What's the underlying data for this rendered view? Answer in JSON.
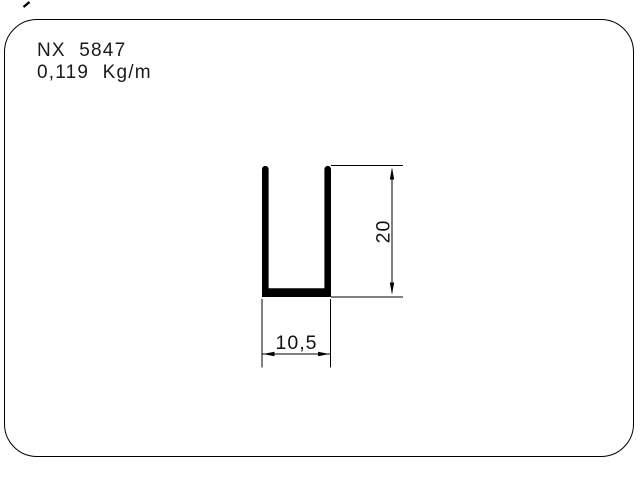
{
  "colors": {
    "background": "#ffffff",
    "line": "#000000",
    "text": "#1a1a1a"
  },
  "header": {
    "profile_code": "NX 5847",
    "weight_per_meter": "0,119 Kg/m"
  },
  "drawing": {
    "shape": "u-channel-profile",
    "dimensions": {
      "height_value": "20",
      "width_value": "10,5"
    }
  }
}
